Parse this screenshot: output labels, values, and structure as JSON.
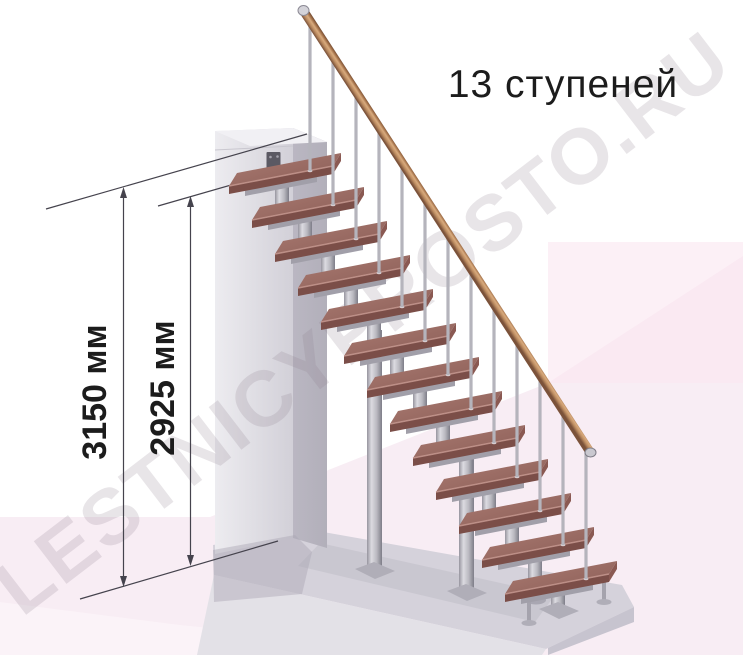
{
  "title": "13 ступеней",
  "watermark": "LESTNICYPROSTO.RU",
  "dimensions": {
    "overall_height": "3150 мм",
    "height_to_top_tread": "2925 мм"
  },
  "stair": {
    "steps": 13
  },
  "colors": {
    "background": "#ffffff",
    "back_wall_pink": "#fcf0f6",
    "back_wall_shade": "#f9e7f0",
    "floor_pink": "#f8edf4",
    "floor_light": "#fbf3f8",
    "podium_top": "#d5d2db",
    "podium_front": "#e3e1e7",
    "podium_side": "#c7c4cf",
    "wall_front_light": "#edecf0",
    "wall_front_dark": "#d2d0d8",
    "wall_side": "#b2afba",
    "wall_top": "#f1f0f4",
    "bracket": "#5b5963",
    "tread_top_light": "#ab7b72",
    "tread_top_dark": "#8a5d56",
    "tread_front": "#7b4e48",
    "tread_side": "#8a5952",
    "tread_edge": "#c4978e",
    "metal_light": "#dcdbe1",
    "metal_dark": "#7e7d88",
    "metal_mid": "#a19fa9",
    "metal_plate": "#b0aeb8",
    "baluster": "#b5b4bc",
    "rail_dark": "#6f4830",
    "rail_light": "#d9ab7e",
    "dimension": "#45434d",
    "text": "#1c1c1c",
    "watermark": "#8d7b8e"
  }
}
